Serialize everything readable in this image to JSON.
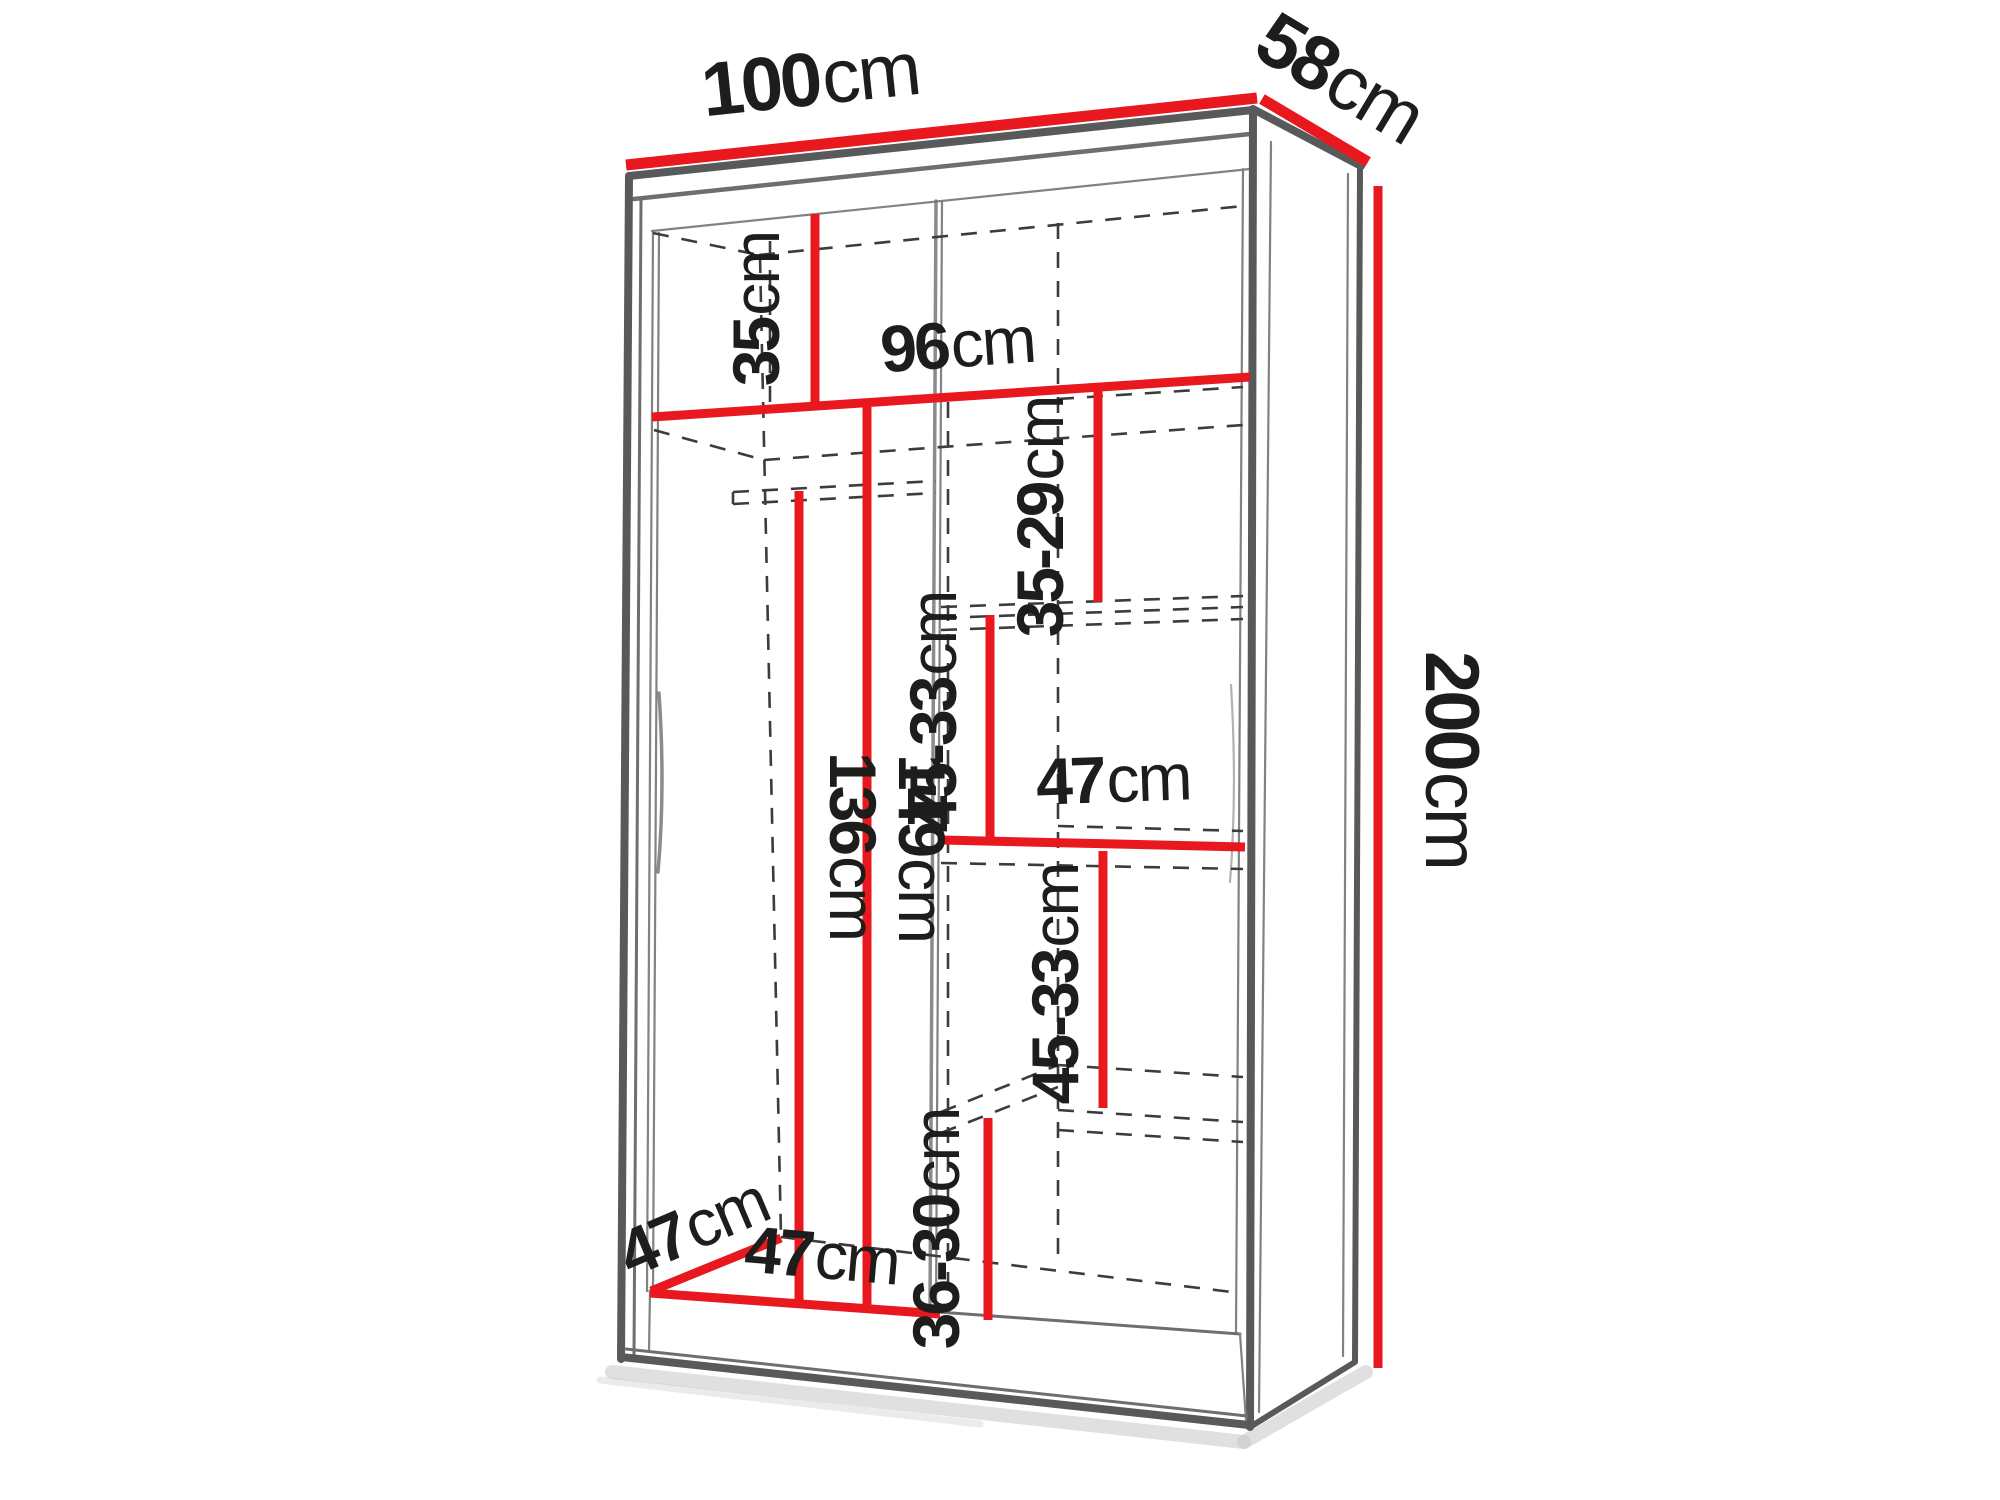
{
  "title": "wardrobe interior dimensions diagram",
  "colors": {
    "dimension_red": "#e8181e",
    "outline_gray": "#58595b",
    "dash_gray": "#3c3c3c",
    "text_black": "#1d1d1b"
  },
  "labels": {
    "width_top": {
      "value": "100",
      "unit": "cm"
    },
    "depth_top": {
      "value": "58",
      "unit": "cm"
    },
    "height_right": {
      "value": "200",
      "unit": "cm"
    },
    "top_compartment": {
      "value": "35",
      "unit": "cm"
    },
    "interior_width": {
      "value": "96",
      "unit": "cm"
    },
    "upper_shelf_gap": {
      "value": "35-29",
      "unit": "cm"
    },
    "mid_shelf_gap_left": {
      "value": "45-33",
      "unit": "cm"
    },
    "shelf_width": {
      "value": "47",
      "unit": "cm"
    },
    "mid_shelf_gap_right": {
      "value": "45-33",
      "unit": "cm"
    },
    "lower_shelf_gap": {
      "value": "36-30",
      "unit": "cm"
    },
    "rod_to_floor": {
      "value": "136",
      "unit": "cm"
    },
    "hanging_height": {
      "value": "149",
      "unit": "cm"
    },
    "floor_depth": {
      "value": "47",
      "unit": "cm"
    },
    "left_section_width": {
      "value": "47",
      "unit": "cm"
    }
  }
}
